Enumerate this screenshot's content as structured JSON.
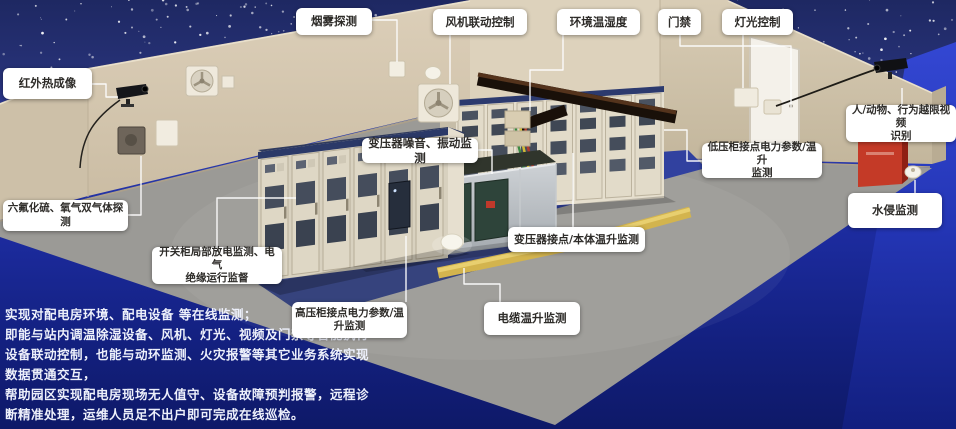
{
  "labels": [
    {
      "id": "smoke-detection",
      "text": "烟雾探测"
    },
    {
      "id": "fan-linkage-control",
      "text": "风机联动控制"
    },
    {
      "id": "env-temp-humidity",
      "text": "环境温湿度"
    },
    {
      "id": "access-control",
      "text": "门禁"
    },
    {
      "id": "lighting-control",
      "text": "灯光控制"
    },
    {
      "id": "infrared-thermal-imaging",
      "text": "红外热成像"
    },
    {
      "id": "sf6-o2-gas-detection",
      "text": "六氟化硫、氧气双气体探测"
    },
    {
      "id": "switchgear-partial-discharge",
      "text": "开关柜局部放电监测、电气\n绝缘运行监督"
    },
    {
      "id": "transformer-noise-vibration",
      "text": "变压器噪音、振动监测"
    },
    {
      "id": "transformer-contact-temp",
      "text": "变压器接点/本体温升监测"
    },
    {
      "id": "hv-cabinet-power-temp",
      "text": "高压柜接点电力参数/温\n升监测"
    },
    {
      "id": "cable-temp-rise",
      "text": "电缆温升监测"
    },
    {
      "id": "lv-cabinet-power-temp",
      "text": "低压柜接点电力参数/温升\n监测"
    },
    {
      "id": "video-behavior-recognition",
      "text": "人/动物、行为越限视频\n识别"
    },
    {
      "id": "water-intrusion",
      "text": "水侵监测"
    }
  ],
  "description": {
    "text": "实现对配电房环境、配电设备 等在线监测；\n即能与站内调温除湿设备、风机、灯光、视频及门禁等智能执行\n设备联动控制，也能与动环监测、火灾报警等其它业务系统实现\n数据贯通交互，\n帮助园区实现配电房现场无人值守、设备故障预判报警，远程诊\n断精准处理，运维人员足不出户即可完成在线巡检。"
  },
  "scene_objects": [
    "infrared-camera",
    "exhaust-fan",
    "smoke-detector",
    "temp-humidity-sensor",
    "access-door",
    "light-switch",
    "surveillance-camera",
    "fire-extinguisher-cabinet",
    "water-sensor",
    "hv-switchgear-row",
    "lv-switchgear-row",
    "transformer-enclosure",
    "overhead-cable-tray",
    "floor-cable-duct",
    "gas-sensor"
  ],
  "colors": {
    "sky_navy": "#212b68",
    "outside_blue": "#1d2b9e",
    "bright_blue_band": "#2e41cf",
    "wall_beige": "#d8ccb6",
    "floor_gray": "#9b9a96",
    "cabinet_mat_blue": "#36437d",
    "label_bg": "#ffffff",
    "label_text": "#2e2c29",
    "description_text": "#edf0fb",
    "alarm_red": "#c43a27",
    "cable_duct_yellow": "#d3b44e"
  }
}
